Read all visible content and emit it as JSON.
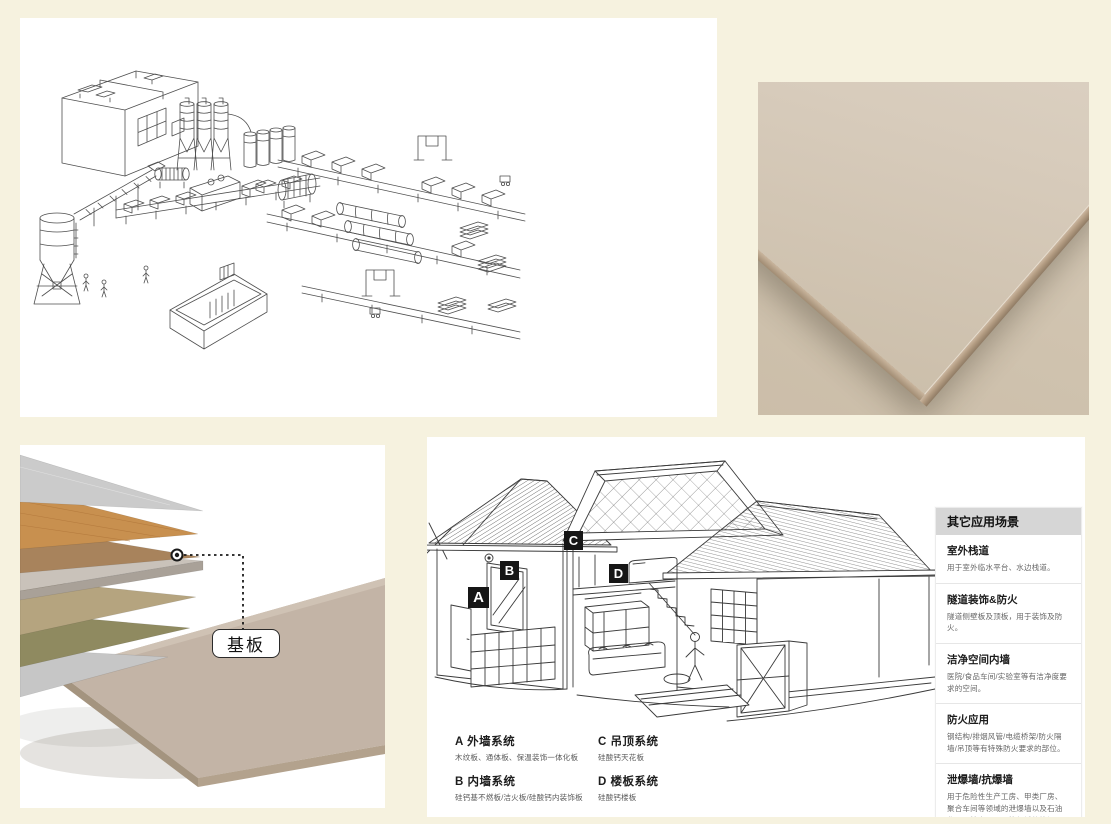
{
  "page": {
    "background": "#f6f2df"
  },
  "colors": {
    "marker_bg": "#161616",
    "sidebar_header_bg": "#d6d6d6",
    "board_beige": "#c3b4a6",
    "line_art": "#4a4a4a"
  },
  "substrate": {
    "callout_label": "基板"
  },
  "house": {
    "markers": [
      {
        "letter": "A"
      },
      {
        "letter": "B"
      },
      {
        "letter": "C"
      },
      {
        "letter": "D"
      }
    ],
    "legend": [
      {
        "code": "A",
        "title": "外墙系统",
        "desc": "木纹板、通体板、保温装饰一体化板"
      },
      {
        "code": "B",
        "title": "内墙系统",
        "desc": "硅钙基不燃板/洁火板/硅酸钙内装饰板"
      },
      {
        "code": "C",
        "title": "吊顶系统",
        "desc": "硅酸钙天花板"
      },
      {
        "code": "D",
        "title": "楼板系统",
        "desc": "硅酸钙楼板"
      }
    ],
    "sidebar": {
      "title": "其它应用场景",
      "items": [
        {
          "title": "室外栈道",
          "desc": "用于室外临水平台、水边栈道。"
        },
        {
          "title": "隧道装饰&防火",
          "desc": "隧道侧壁板及顶板，用于装饰及防火。"
        },
        {
          "title": "洁净空间内墙",
          "desc": "医院/食品车间/实验室等有洁净度要求的空间。"
        },
        {
          "title": "防火应用",
          "desc": "钢结构/排烟风管/电缆桥架/防火隔墙/吊顶等有特殊防火要求的部位。"
        },
        {
          "title": "泄爆墙/抗爆墙",
          "desc": "用于危险性生产工房、甲类厂房、聚合车间等领域的泄爆墙以及石油化工、核电、军工等领域的抗爆墙。"
        }
      ]
    }
  }
}
